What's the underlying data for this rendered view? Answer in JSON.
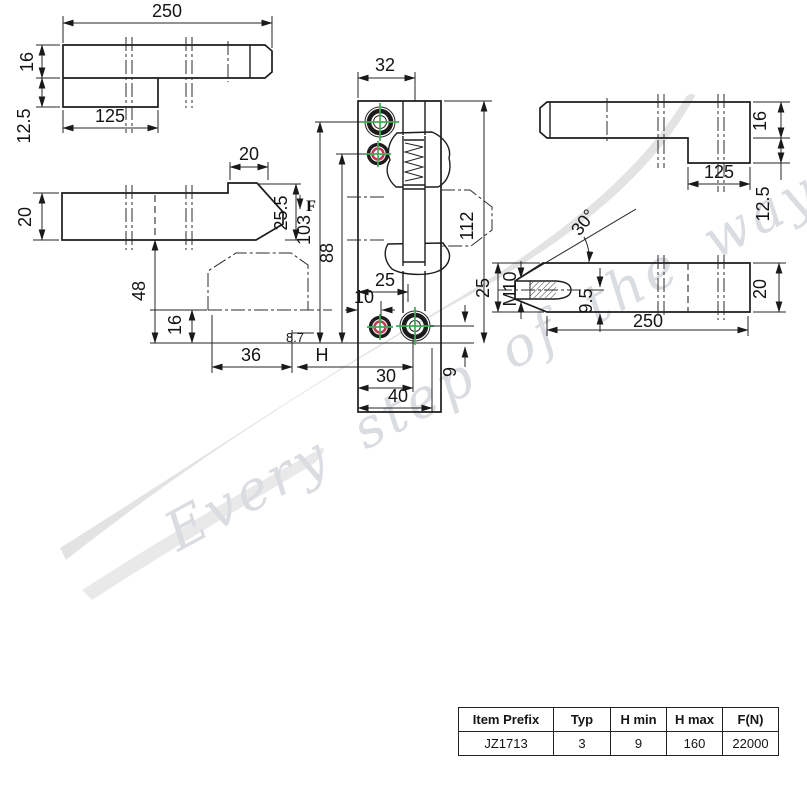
{
  "watermark": {
    "slogan": "Every step of the way"
  },
  "views": {
    "bar_top_left": {
      "length": "250",
      "thickness": "16",
      "step_length": "125",
      "step_depth": "12.5"
    },
    "arm_side_left": {
      "width": "20",
      "nose_length": "20",
      "nose_height": "25.5",
      "force": "F",
      "height_hole1": "103",
      "height_hole2": "88",
      "arm_height": "48",
      "keeper_thickness": "16",
      "keeper_offset": "36",
      "travel": "H",
      "detail": "8.7"
    },
    "housing_front": {
      "hole_offset": "32",
      "height": "112",
      "col_spacing": "25",
      "col_offset": "10",
      "base_spacing": "30",
      "base_width": "40",
      "base_offset": "9"
    },
    "arm_side_right": {
      "chamfer_angle": "30°",
      "thread": "M10",
      "screw_offset": "9.5",
      "length": "250",
      "width": "20",
      "nose_height": "25"
    },
    "bar_top_right": {
      "thickness": "16",
      "step_length": "125",
      "step_depth": "12.5"
    }
  },
  "table": {
    "headers": [
      "Item Prefix",
      "Typ",
      "H min",
      "H max",
      "F(N)"
    ],
    "rows": [
      [
        "JZ1713",
        "3",
        "9",
        "160",
        "22000"
      ]
    ]
  }
}
